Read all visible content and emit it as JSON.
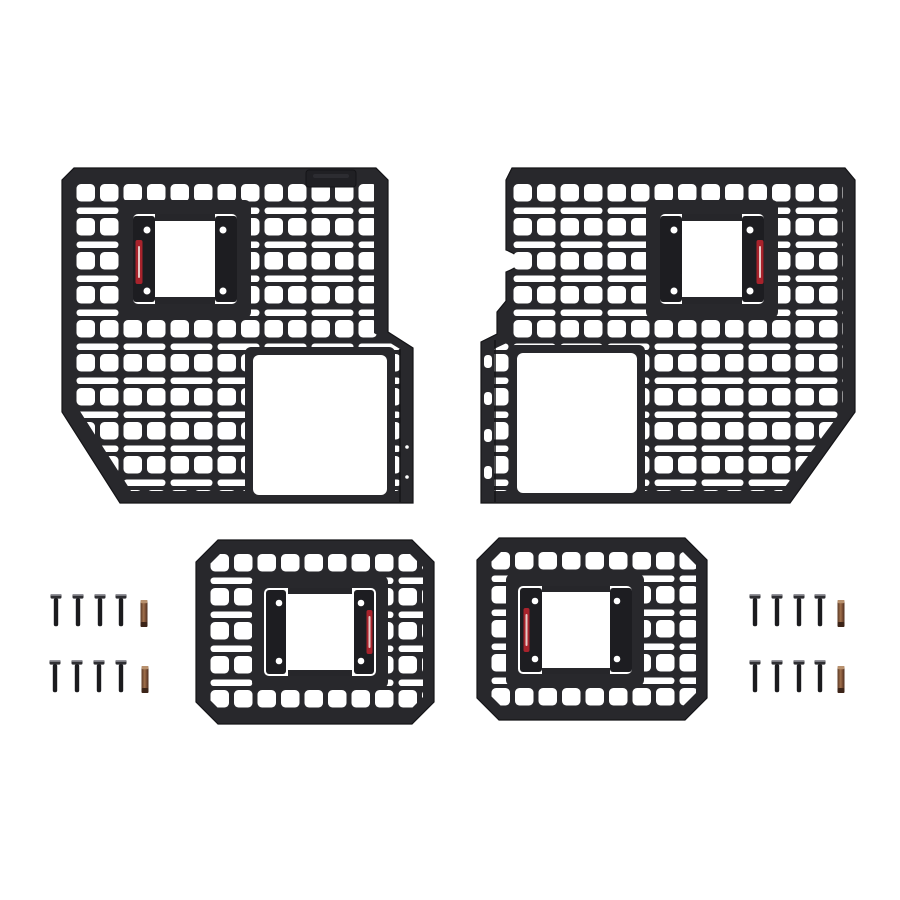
{
  "scene": {
    "kind": "product-photo",
    "subject": "4-piece modular MOLLE bedside rack panel kit with mounting hardware",
    "background_color": "#ffffff"
  },
  "colors": {
    "panel": "#28282c",
    "panel_edge": "#141417",
    "bracket_dark": "#1d1d21",
    "hole": "#ffffff",
    "sticker_red": "#a8232c",
    "sticker_text": "#f2e8e2",
    "bolt_shaft": "#1b1b1e",
    "bolt_head": "#2f2f33",
    "bolt_head_highlight": "#93939a",
    "bit_copper": "#8a5a3e",
    "bit_copper_light": "#b8916e",
    "bit_copper_dark": "#593826"
  },
  "kit": {
    "panel_count": 4,
    "panels": [
      {
        "id": "large-panel-left",
        "size": "large",
        "position": "top-left",
        "features": {
          "molle_grid": true,
          "top_mounting_tab": true,
          "side_flange": "right",
          "bracket_location": "upper-left",
          "bracket_label_side": "left",
          "large_cutout_location": "bottom-right",
          "angled_corner": "bottom-left"
        }
      },
      {
        "id": "large-panel-right",
        "size": "large",
        "position": "top-right",
        "features": {
          "molle_grid": true,
          "top_mounting_tab": false,
          "side_flange": "left",
          "edge_notch": "left",
          "bracket_location": "upper-right",
          "bracket_label_side": "right",
          "large_cutout_location": "bottom-left",
          "angled_corner": "bottom-right"
        }
      },
      {
        "id": "small-panel-left",
        "size": "small",
        "position": "bottom-center-left",
        "features": {
          "molle_grid": true,
          "shape": "octagonal",
          "bracket_location": "center",
          "bracket_label_side": "right"
        }
      },
      {
        "id": "small-panel-right",
        "size": "small",
        "position": "bottom-center-right",
        "features": {
          "molle_grid": true,
          "shape": "octagonal",
          "bracket_location": "center",
          "bracket_label_side": "left"
        }
      }
    ],
    "hardware": {
      "bolt_total": 16,
      "bit_total": 4,
      "groups": [
        {
          "id": "hardware-left",
          "position": "middle-left",
          "rows": 2,
          "bolts_per_row": 4,
          "bits_per_row": 1
        },
        {
          "id": "hardware-right",
          "position": "middle-right",
          "rows": 2,
          "bolts_per_row": 4,
          "bits_per_row": 1
        }
      ]
    }
  }
}
